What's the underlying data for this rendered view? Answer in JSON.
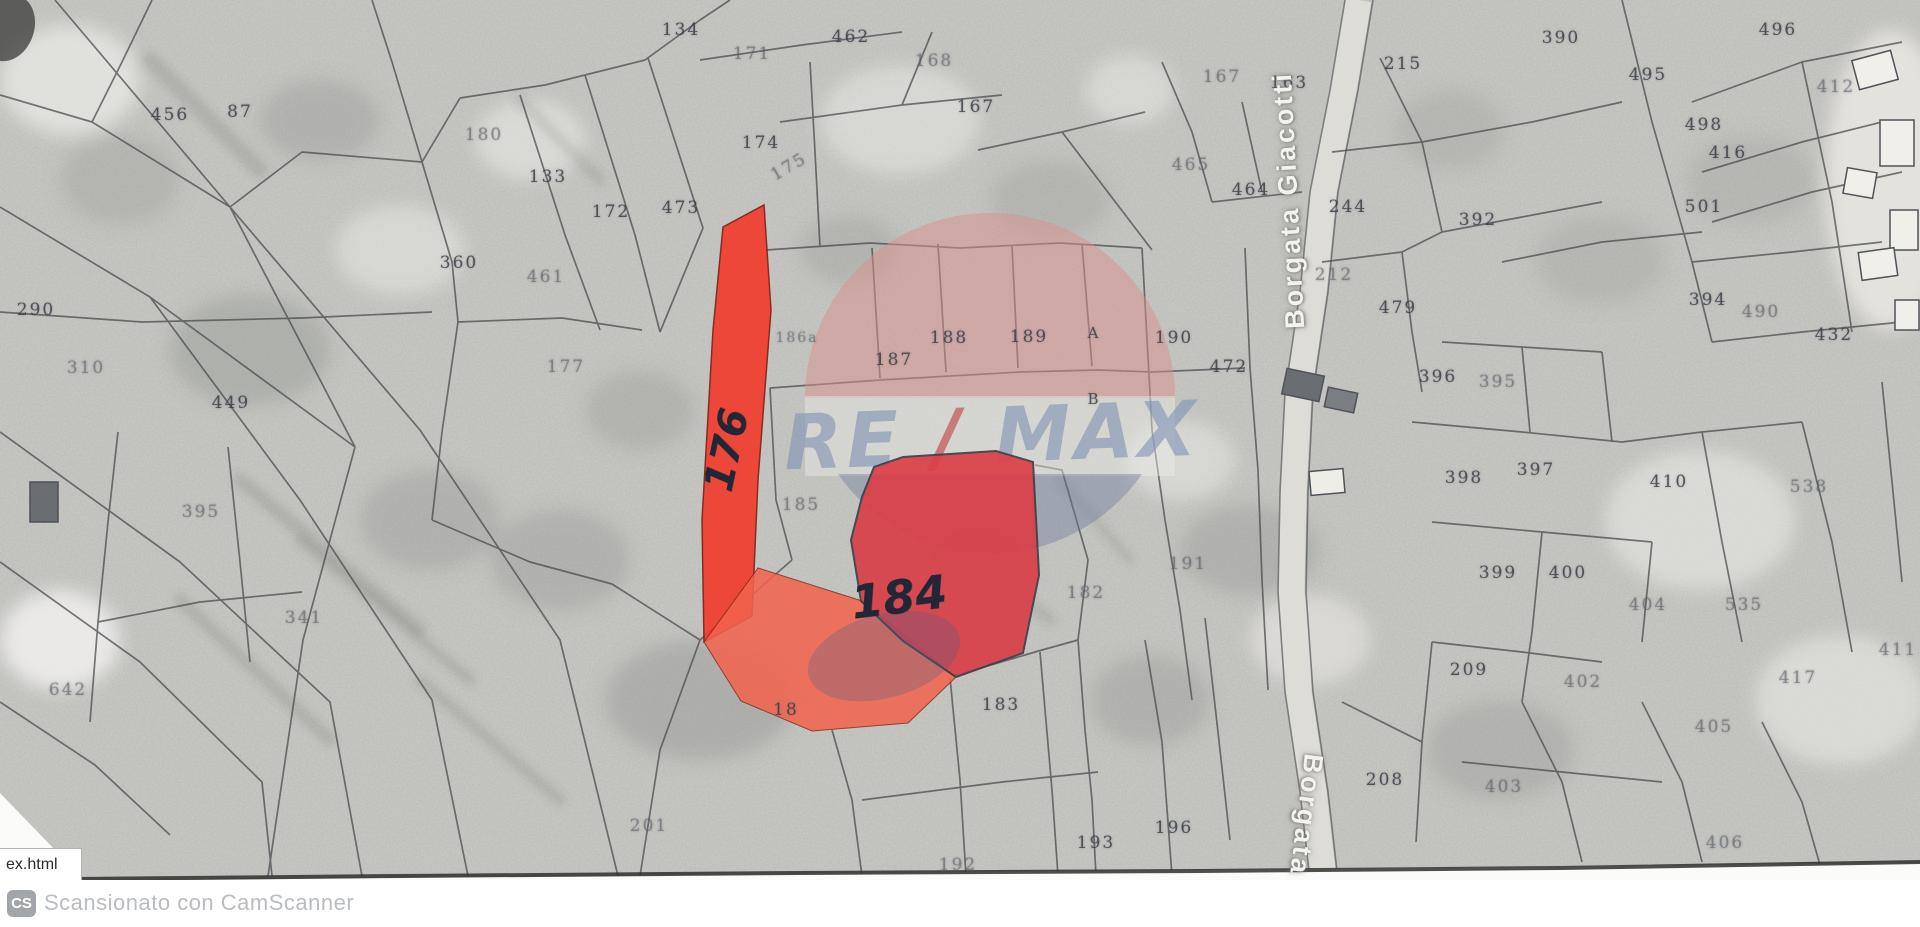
{
  "map": {
    "road_labels": {
      "top": "Borgata Giacotti",
      "bottom": "Borgata"
    },
    "watermark": {
      "re": "RE",
      "slash": "/",
      "max": "MAX"
    },
    "handwritten": [
      {
        "text": "176",
        "x": 727,
        "y": 450,
        "rot": -78,
        "size": 40
      },
      {
        "text": "184",
        "x": 899,
        "y": 597,
        "rot": -7,
        "size": 46
      }
    ],
    "parcel_labels": [
      {
        "t": "456",
        "x": 170,
        "y": 115
      },
      {
        "t": "87",
        "x": 240,
        "y": 112
      },
      {
        "t": "134",
        "x": 681,
        "y": 30
      },
      {
        "t": "171",
        "x": 752,
        "y": 54,
        "f": 1
      },
      {
        "t": "462",
        "x": 851,
        "y": 37
      },
      {
        "t": "168",
        "x": 934,
        "y": 61,
        "f": 1
      },
      {
        "t": "167",
        "x": 976,
        "y": 107
      },
      {
        "t": "167",
        "x": 1222,
        "y": 77,
        "f": 1
      },
      {
        "t": "163",
        "x": 1289,
        "y": 83
      },
      {
        "t": "215",
        "x": 1403,
        "y": 64
      },
      {
        "t": "390",
        "x": 1561,
        "y": 38
      },
      {
        "t": "496",
        "x": 1778,
        "y": 30
      },
      {
        "t": "495",
        "x": 1648,
        "y": 75
      },
      {
        "t": "412",
        "x": 1836,
        "y": 87,
        "f": 1
      },
      {
        "t": "498",
        "x": 1704,
        "y": 125
      },
      {
        "t": "416",
        "x": 1728,
        "y": 153
      },
      {
        "t": "501",
        "x": 1704,
        "y": 207
      },
      {
        "t": "180",
        "x": 484,
        "y": 135,
        "f": 1
      },
      {
        "t": "133",
        "x": 548,
        "y": 177
      },
      {
        "t": "172",
        "x": 611,
        "y": 212
      },
      {
        "t": "473",
        "x": 681,
        "y": 208
      },
      {
        "t": "174",
        "x": 761,
        "y": 143
      },
      {
        "t": "175",
        "x": 789,
        "y": 167,
        "f": 1,
        "r": -30
      },
      {
        "t": "360",
        "x": 459,
        "y": 263
      },
      {
        "t": "461",
        "x": 546,
        "y": 277,
        "f": 1
      },
      {
        "t": "290",
        "x": 36,
        "y": 310
      },
      {
        "t": "310",
        "x": 86,
        "y": 368,
        "f": 1
      },
      {
        "t": "449",
        "x": 231,
        "y": 403
      },
      {
        "t": "395",
        "x": 201,
        "y": 512,
        "f": 1
      },
      {
        "t": "341",
        "x": 304,
        "y": 618,
        "f": 1
      },
      {
        "t": "642",
        "x": 68,
        "y": 690,
        "f": 1
      },
      {
        "t": "177",
        "x": 566,
        "y": 367,
        "f": 1
      },
      {
        "t": "186a",
        "x": 797,
        "y": 338,
        "f": 1,
        "s": 14
      },
      {
        "t": "187",
        "x": 894,
        "y": 360
      },
      {
        "t": "188",
        "x": 949,
        "y": 338
      },
      {
        "t": "189",
        "x": 1029,
        "y": 337
      },
      {
        "t": "A",
        "x": 1094,
        "y": 333,
        "s": 15
      },
      {
        "t": "190",
        "x": 1174,
        "y": 338
      },
      {
        "t": "472",
        "x": 1229,
        "y": 367
      },
      {
        "t": "B",
        "x": 1094,
        "y": 399,
        "s": 15
      },
      {
        "t": "185",
        "x": 801,
        "y": 505,
        "f": 1
      },
      {
        "t": "182",
        "x": 1086,
        "y": 593,
        "f": 1
      },
      {
        "t": "191",
        "x": 1188,
        "y": 564,
        "f": 1
      },
      {
        "t": "465",
        "x": 1191,
        "y": 165,
        "f": 1
      },
      {
        "t": "464",
        "x": 1251,
        "y": 190
      },
      {
        "t": "244",
        "x": 1348,
        "y": 207
      },
      {
        "t": "392",
        "x": 1478,
        "y": 220
      },
      {
        "t": "212",
        "x": 1334,
        "y": 275,
        "f": 1
      },
      {
        "t": "479",
        "x": 1398,
        "y": 308
      },
      {
        "t": "394",
        "x": 1708,
        "y": 300
      },
      {
        "t": "490",
        "x": 1761,
        "y": 312,
        "f": 1
      },
      {
        "t": "432",
        "x": 1834,
        "y": 335
      },
      {
        "t": "396",
        "x": 1438,
        "y": 377
      },
      {
        "t": "395",
        "x": 1498,
        "y": 382,
        "f": 1
      },
      {
        "t": "398",
        "x": 1464,
        "y": 478
      },
      {
        "t": "397",
        "x": 1536,
        "y": 470
      },
      {
        "t": "410",
        "x": 1669,
        "y": 482
      },
      {
        "t": "538",
        "x": 1809,
        "y": 487,
        "f": 1
      },
      {
        "t": "399",
        "x": 1498,
        "y": 573
      },
      {
        "t": "400",
        "x": 1568,
        "y": 573
      },
      {
        "t": "404",
        "x": 1648,
        "y": 605,
        "f": 1
      },
      {
        "t": "535",
        "x": 1744,
        "y": 605,
        "f": 1
      },
      {
        "t": "411",
        "x": 1898,
        "y": 650,
        "f": 1
      },
      {
        "t": "209",
        "x": 1469,
        "y": 670
      },
      {
        "t": "402",
        "x": 1583,
        "y": 682,
        "f": 1
      },
      {
        "t": "417",
        "x": 1798,
        "y": 678,
        "f": 1
      },
      {
        "t": "405",
        "x": 1714,
        "y": 727,
        "f": 1
      },
      {
        "t": "406",
        "x": 1725,
        "y": 843,
        "f": 1
      },
      {
        "t": "208",
        "x": 1385,
        "y": 780
      },
      {
        "t": "403",
        "x": 1504,
        "y": 787,
        "f": 1
      },
      {
        "t": "196",
        "x": 1174,
        "y": 828
      },
      {
        "t": "193",
        "x": 1096,
        "y": 843
      },
      {
        "t": "192",
        "x": 958,
        "y": 865,
        "f": 1
      },
      {
        "t": "183",
        "x": 1001,
        "y": 705
      },
      {
        "t": "18",
        "x": 786,
        "y": 710
      },
      {
        "t": "201",
        "x": 649,
        "y": 826,
        "f": 1
      }
    ],
    "colors": {
      "highlight_strip": "#f13a2a",
      "highlight_main": "#da3f48",
      "highlight_light": "#f2634d",
      "watermark_pink": "#d9908b",
      "watermark_blue": "#68799c",
      "watermark_text": "#7e91b4",
      "watermark_slash": "#bf4040"
    }
  },
  "status_bar": {
    "filename": "ex.html"
  },
  "footer": {
    "badge_label": "CS",
    "text": "Scansionato con CamScanner"
  }
}
